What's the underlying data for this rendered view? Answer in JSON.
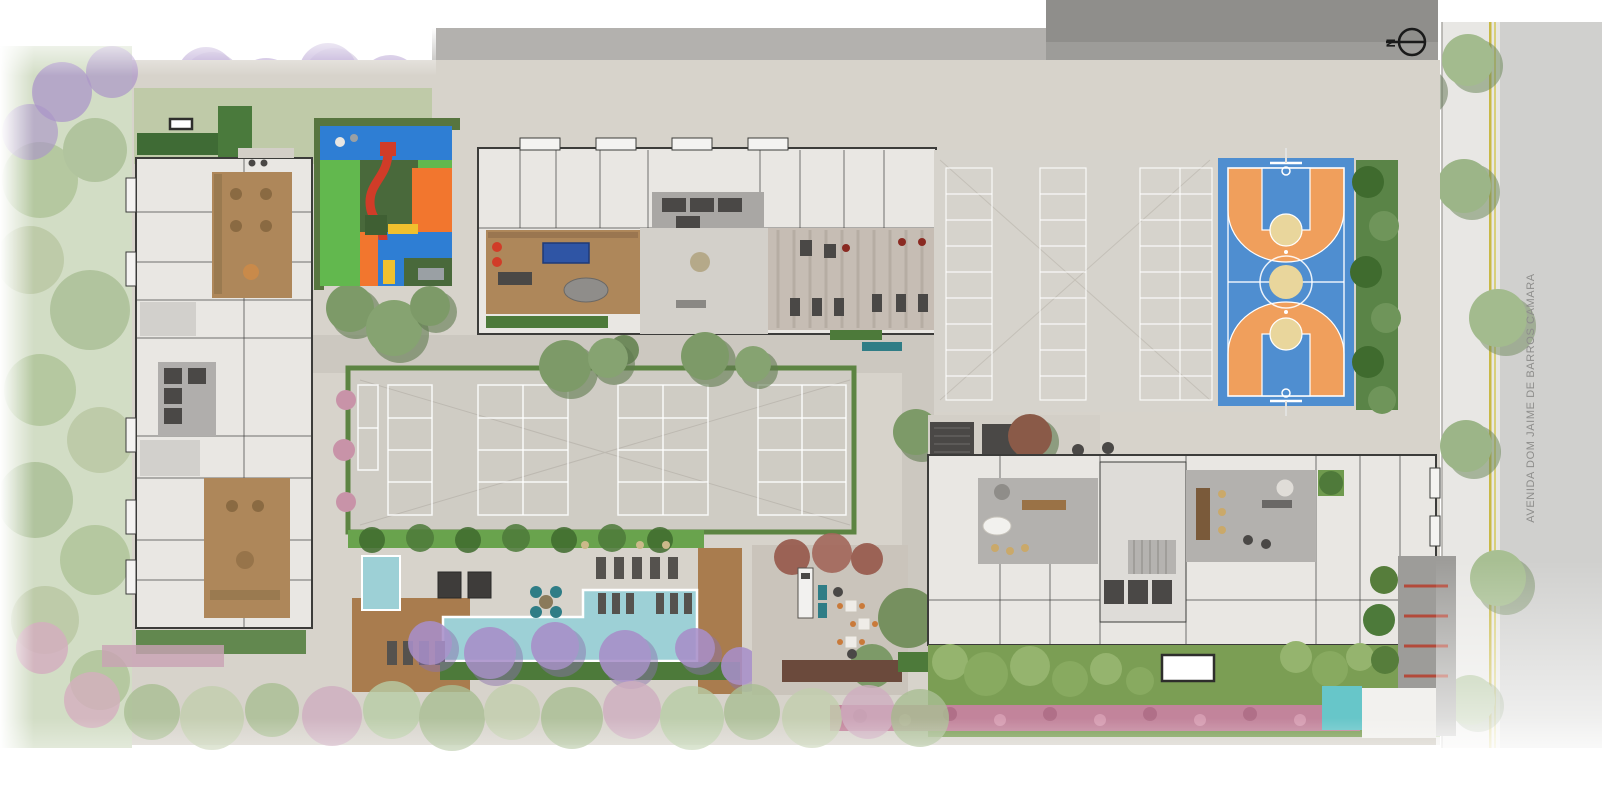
{
  "meta": {
    "type": "architectural-site-plan",
    "description": "Aerial illustrated implantation plan of a residential complex with leisure areas"
  },
  "compass": {
    "label": "N"
  },
  "street": {
    "label": "AVENIDA DOM JAIME DE BARROS CAMARA"
  },
  "areas": [
    "left-tower-building",
    "north-building",
    "east-building",
    "kids-playground",
    "multisport-plaza",
    "lap-pool",
    "kids-pool",
    "pool-deck",
    "barbecue-area",
    "games-lounge",
    "gym",
    "food-truck-terrace",
    "parking-lot",
    "basketball-court",
    "south-lawn",
    "flower-hedge",
    "street-sidewalk",
    "access-driveway",
    "water-feature"
  ],
  "colors": {
    "paving": "#d7d3cb",
    "road_gray": "#b3b1ae",
    "dark_pavement": "#9d9c99",
    "darker_pavement": "#8f8e8b",
    "street_gray": "#d0d0ce",
    "sidewalk": "#e8e7e4",
    "lawn_green": "#7b9e54",
    "garden_lawn": "#bfcaa8",
    "hedge_green": "#4d7a3a",
    "pool_hedge": "#69a34d",
    "deck_wood": "#a97c4e",
    "interior_wood": "#ae875a",
    "pool_water": "#9dd0d6",
    "water_feature": "#67c6c9",
    "court_blue": "#4f8ed0",
    "court_orange": "#f09f5c",
    "court_tan": "#e9d69c",
    "playground_green": "#62b84e",
    "playground_blue": "#2e7ed4",
    "playground_orange": "#f2762e",
    "playground_olive": "#49693b",
    "playground_red": "#d13c28",
    "playground_yellow": "#f0c02e",
    "parking_base": "#d6d3cc",
    "pink_flowers": "#c2849b",
    "purple_trees": "#a88fc9",
    "tree_green": "#8fae7d",
    "building_floor": "#e9e7e3",
    "lounge_gray": "#b3b1ae",
    "gym_floor": "#c6bdb4",
    "accent_teal": "#2f7d86",
    "wall_dark": "#3c3c3a",
    "street_line_yellow": "#c9b945"
  }
}
